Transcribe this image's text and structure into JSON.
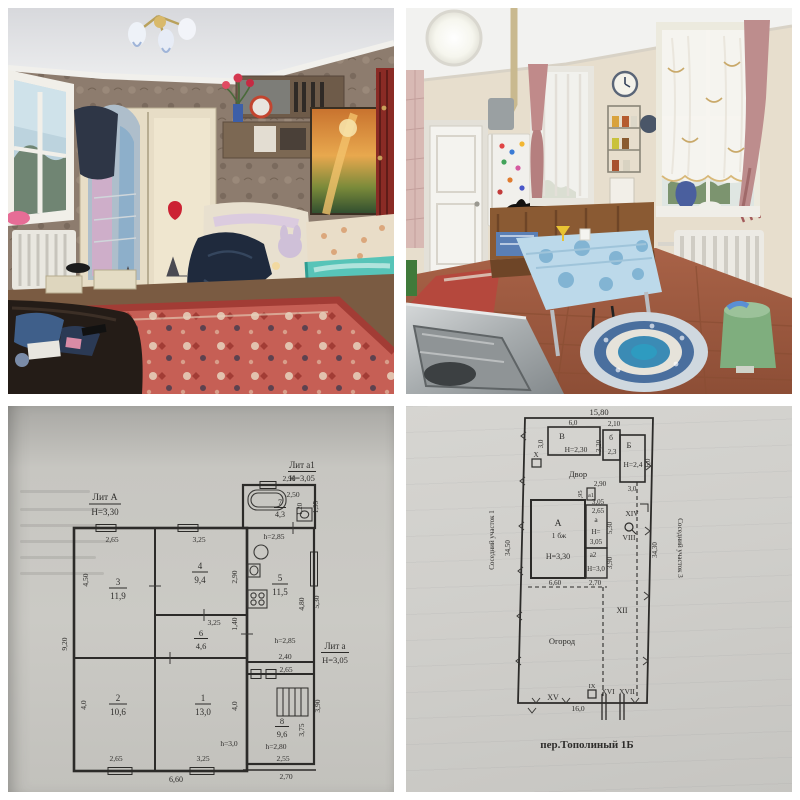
{
  "colors": {
    "paper_left": "#c7c6c1",
    "paper_right": "#d0cfcb",
    "ink": "#2e2d2b",
    "carpet_red": "#c65f55",
    "bed_teal": "#57c4b8",
    "bin_green": "#7fae7e"
  },
  "plan_house": {
    "lit_a": "Лит А",
    "lit_a_h": "Н=3,30",
    "lit_a1": "Лит а1",
    "lit_a1_h": "Н=3,05",
    "lit_a_small": "Лит а",
    "lit_a_small_h": "Н=3,05",
    "bath_top": "2,90",
    "bath_inner": "2,50",
    "room7_num": "7",
    "room7_area": "4,3",
    "bath_v1": "1,20",
    "bath_v2": "1,95",
    "bath_height": "h=2,85",
    "room3_num": "3",
    "room3_area": "11,9",
    "room3_top": "2,65",
    "room3_left": "4,50",
    "room4_num": "4",
    "room4_area": "9,4",
    "room4_top": "3,25",
    "room4_right": "2,90",
    "room5_num": "5",
    "room5_area": "11,5",
    "room5_right1": "4,80",
    "room5_right2": "5,30",
    "room5_height": "h=2,85",
    "room6_num": "6",
    "room6_area": "4,6",
    "room6_top": "3,25",
    "room6_right": "1,40",
    "left_total": "9,20",
    "room2_num": "2",
    "room2_area": "10,6",
    "room2_left": "4,0",
    "room2_bottom": "2,65",
    "room1_num": "1",
    "room1_area": "13,0",
    "room1_right": "4,0",
    "room1_bottom": "3,25",
    "room1_height": "h=3,0",
    "bottom_total": "6,60",
    "pass_top": "2,40",
    "pass_bottom": "2,65",
    "room8_num": "8",
    "room8_area": "9,6",
    "room8_right1": "3,90",
    "room8_right2": "3,75",
    "room8_height": "h=2,80",
    "room8_bottom1": "2,55",
    "room8_bottom2": "2,70"
  },
  "plan_site": {
    "total_top": "15,80",
    "bldg_v": "В",
    "bldg_v_h": "Н=2,30",
    "bldg_v_w": "6,0",
    "bldg_v_d": "3,0",
    "dim_2_10": "2,10",
    "dim_3_20": "3,20",
    "bldg_b2": "б",
    "bldg_b2_area": "2,3",
    "bldg_b": "Б",
    "bldg_b_h": "Н=2,4",
    "bldg_b_d": "6,0",
    "bldg_b_w": "3,0",
    "yard": "Двор",
    "rom_x": "X",
    "dim_2_90": "2,90",
    "dim_1_95": "1,95",
    "a1": "а1",
    "dim_3_05a": "3,05",
    "dim_2_65": "2,65",
    "a": "а",
    "a_h1": "Н=",
    "a_h2": "3,05",
    "dim_5_30": "5,30",
    "main": "А",
    "main_note": "1 бж",
    "main_h": "Н=3,30",
    "a2": "а2",
    "a2_h": "Н=3,0",
    "dim_3_90": "3,90",
    "dim_6_60": "6,60",
    "dim_2_70": "2,70",
    "rom_xiv": "XIV",
    "rom_viii": "VIII",
    "left_len": "34,50",
    "right_len": "34,30",
    "neighbor1": "Соседний участок 1",
    "neighbor3": "Соседний участок 3",
    "rom_xii": "XII",
    "garden": "Огород",
    "rom_xv": "XV",
    "rom_ix": "IX",
    "rom_xvi": "XVI",
    "rom_xvii": "XVII",
    "bottom_len": "16,0",
    "address": "пер.Тополиный 1Б"
  }
}
